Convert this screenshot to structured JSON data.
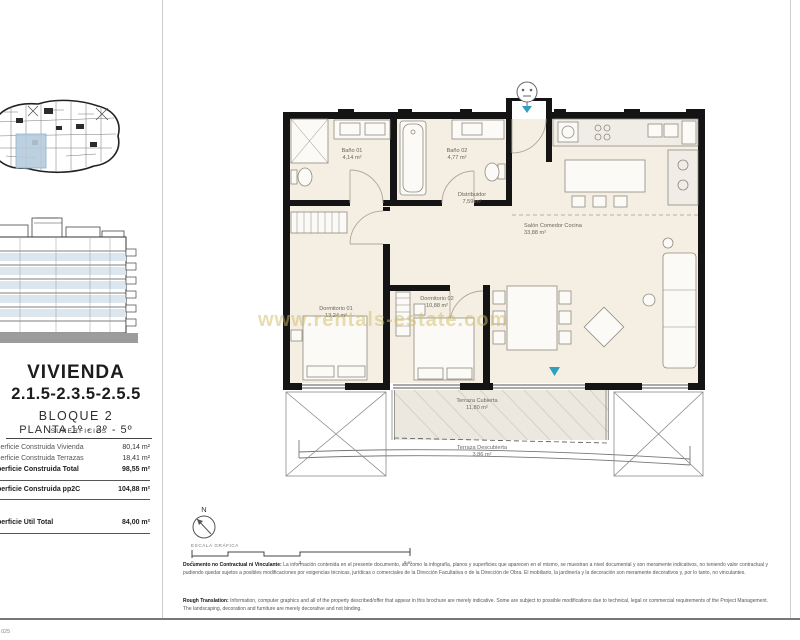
{
  "page": {
    "watermark": "www.rentals-estate.com",
    "doc_ref": "025"
  },
  "title_block": {
    "dwelling_label": "VIVIENDA",
    "unit_numbers": "2.1.5-2.3.5-2.5.5",
    "block_label": "BLOQUE 2",
    "floor_label": "PLANTA 1º - 3º - 5º"
  },
  "surfaces": {
    "heading": "SUPERFICIES",
    "rows": [
      {
        "label": "Superficie Construida Vivienda",
        "value": "80,14 m²"
      },
      {
        "label": "Superficie Construida Terrazas",
        "value": "18,41 m²"
      },
      {
        "label": "Superficie Construida Total",
        "value": "98,55 m²"
      },
      {
        "label": "Superficie Construida pp2C",
        "value": "104,88 m²"
      },
      {
        "label": "Superficie Útil Total",
        "value": "84,00 m²"
      }
    ]
  },
  "floor_plan": {
    "rooms": [
      {
        "name": "Baño 01",
        "area": "4,14 m²"
      },
      {
        "name": "Baño 02",
        "area": "4,77 m²"
      },
      {
        "name": "Distribuidor",
        "area": "7,59 m²"
      },
      {
        "name": "Salón Comedor Cocina",
        "area": "33,88 m²"
      },
      {
        "name": "Dormitorio 01",
        "area": "13,24 m²"
      },
      {
        "name": "Dormitorio 02",
        "area": "10,88 m²"
      },
      {
        "name": "Terraza Cubierta",
        "area": "11,80 m²"
      },
      {
        "name": "Terraza Descubierta",
        "area": "3,86 m²"
      }
    ]
  },
  "compass": {
    "north": "N"
  },
  "scale_bar": {
    "label": "ESCALA GRÁFICA",
    "tick_start": "0",
    "tick_mid": "3",
    "tick_end": "6 m"
  },
  "disclaimers": {
    "es_title": "Documento no Contractual ni Vinculante:",
    "es_body": "La información contenida en el presente documento, así como la infografía, planos y superficies que aparecen en el mismo, se muestran a nivel documental y son meramente indicativos, no teniendo valor contractual y pudiendo quedar sujetos a posibles modificaciones por exigencias técnicas, jurídicas o comerciales de la Dirección Facultativa o de la Dirección de Obra. El mobiliario, la jardinería y la decoración son meramente decorativos y, por lo tanto, no vinculantes.",
    "en_title": "Rough Translation:",
    "en_body": "Information, computer graphics and all of the property described/offer that appear in this brochure are merely indicative. Some are subject to possible modifications due to technical, legal or commercial requirements of the Project Management. The landscaping, decoration and furniture are merely decorative and not binding."
  },
  "colors": {
    "wall_black": "#141414",
    "interior_cream": "#f4eee3",
    "accent_teal": "#2f9fc0",
    "keyplan_highlight": "#b5cbdd",
    "elevation_band": "#dbe6ef",
    "watermark_yellow": "#d0bc64"
  }
}
